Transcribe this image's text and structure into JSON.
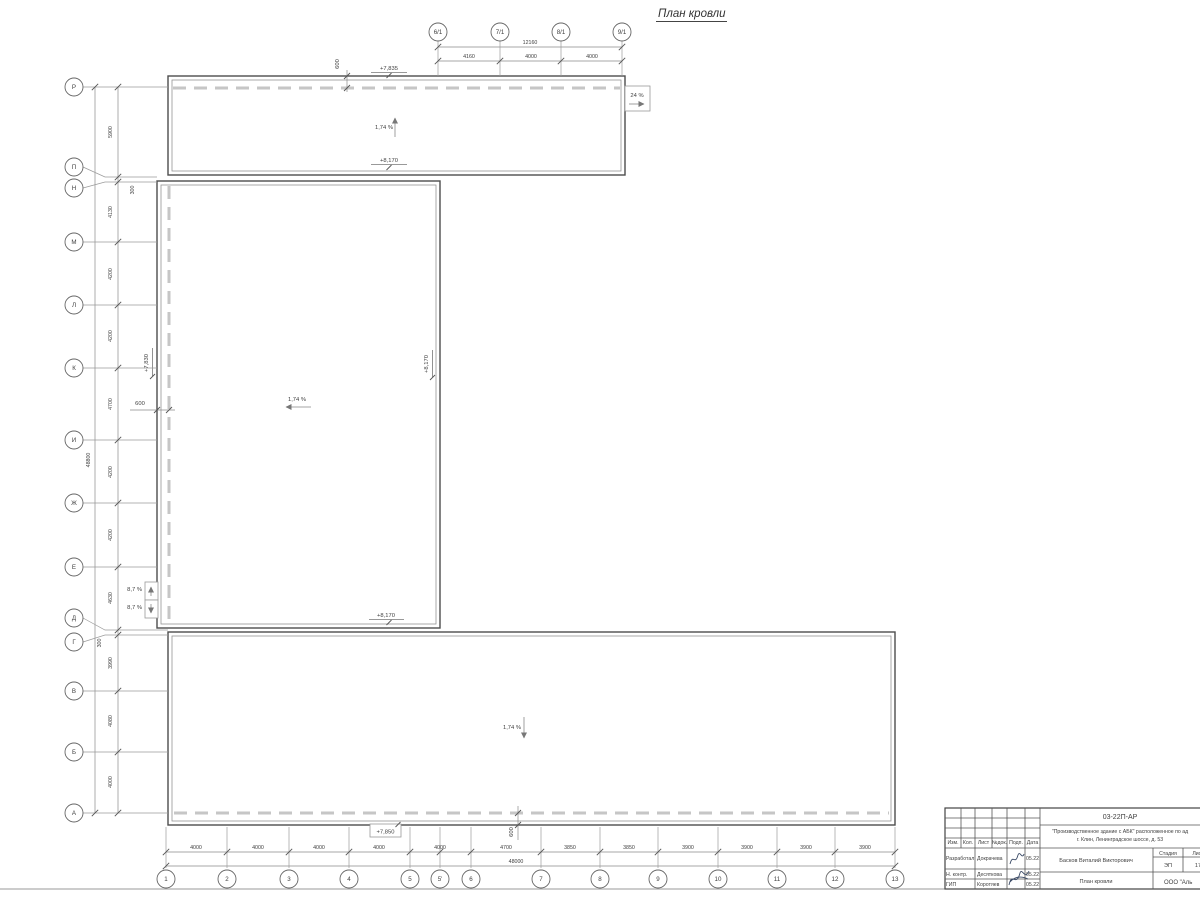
{
  "title": "План кровли",
  "axes": {
    "top": [
      "6/1",
      "7/1",
      "8/1",
      "9/1"
    ],
    "left": [
      "Р",
      "П",
      "Н",
      "М",
      "Л",
      "К",
      "И",
      "Ж",
      "Е",
      "Д",
      "Г",
      "В",
      "Б",
      "А"
    ],
    "bottom": [
      "1",
      "2",
      "3",
      "4",
      "5",
      "5'",
      "6",
      "7",
      "8",
      "9",
      "10",
      "11",
      "12",
      "13"
    ]
  },
  "dimensions": {
    "top_segments": [
      "4160",
      "4000",
      "4000"
    ],
    "top_total": "12160",
    "left_segments": [
      "5900",
      "300",
      "4130",
      "4200",
      "4200",
      "4700",
      "4200",
      "4200",
      "4630",
      "300",
      "3990",
      "4080",
      "4000"
    ],
    "left_total": "48800",
    "bottom_segments": [
      "4000",
      "4000",
      "4000",
      "4000",
      "4000",
      "4700",
      "3850",
      "3850",
      "3900",
      "3900",
      "3900",
      "3900"
    ],
    "bottom_total": "48000"
  },
  "marks": {
    "elev_top_parapet": "+7,835",
    "elev_top_eave": "+8,170",
    "elev_mid_left": "+7,830",
    "elev_mid_right": "+8,170",
    "elev_mid_bottom": "+8,170",
    "elev_bottom": "+7,850",
    "slope_top": "1,74 %",
    "slope_mid": "1,74 %",
    "slope_bottom": "1,74 %",
    "slope_ramp": "24 %",
    "slope_side_top": "8,7 %",
    "slope_side_bottom": "8,7 %",
    "offset_top": "600",
    "offset_mid": "600",
    "offset_bottom": "600"
  },
  "titleblock": {
    "doc_code": "03-22П-АР",
    "project_line1": "\"Производственное здание с АБК\" расположенное по ад",
    "project_line2": "г. Клин, Ленинградское шоссе, д. 53",
    "header_cols": [
      "Изм.",
      "Кол.",
      "Лист",
      "№док.",
      "Подп.",
      "Дата"
    ],
    "rows": [
      {
        "role": "Разработал",
        "name": "Докрачева",
        "date": "05.22"
      },
      {
        "role": "Н. контр.",
        "name": "Десяткова",
        "date": "05.22"
      },
      {
        "role": "ГИП",
        "name": "Коротяев",
        "date": "05.22"
      }
    ],
    "chief": "Басков Виталий Викторович",
    "stage_label": "Стадия",
    "sheet_label": "Лист",
    "stage": "ЭП",
    "sheet": "17",
    "drawing_title": "План кровли",
    "company": "ООО \"Аль"
  }
}
